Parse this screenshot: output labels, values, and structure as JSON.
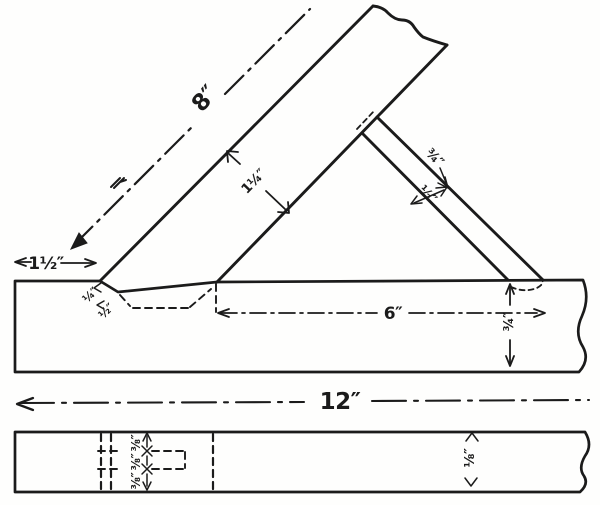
{
  "colors": {
    "ink": "#1b1b1b",
    "paper": "#fefefd"
  },
  "front": {
    "rafter_length": "8″",
    "rafter_width": "1¼″",
    "strut_width": "¾″",
    "strut_lap": "½″",
    "end_offset": "1½″",
    "notch_depth": "¼″",
    "notch_cut": "½″",
    "seat_length": "6″",
    "bar_depth": "¾″",
    "bar_length": "12″"
  },
  "plan": {
    "segments": [
      "⅜″",
      "⅜″",
      "⅜″"
    ],
    "depth": "⅛″"
  }
}
